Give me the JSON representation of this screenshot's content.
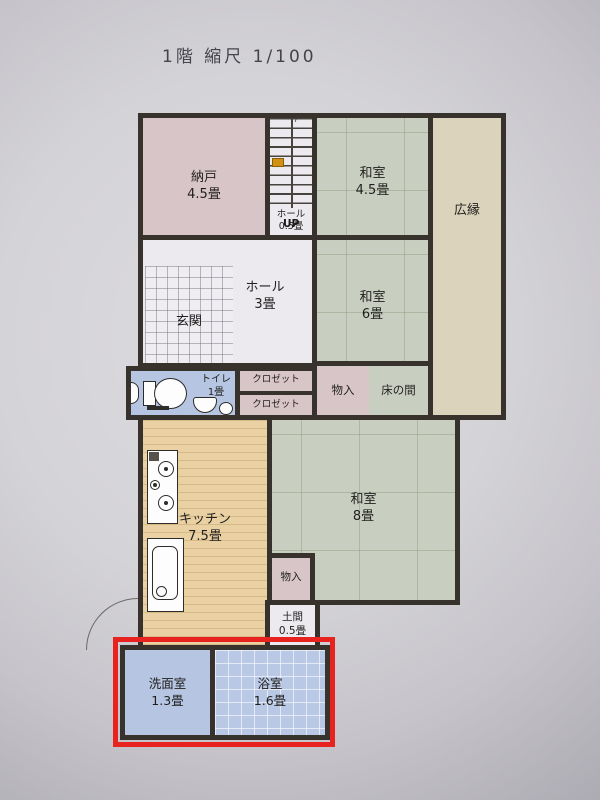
{
  "title": "1階 縮尺 1/100",
  "floor_plan": {
    "rooms": {
      "nando": {
        "name": "納戸",
        "size": "4.5畳"
      },
      "stairs_hall": {
        "name": "ホール",
        "size": "0.5畳",
        "up": "UP"
      },
      "washitsu_45": {
        "name": "和室",
        "size": "4.5畳"
      },
      "hiroen": {
        "name": "広縁"
      },
      "genkan": {
        "name": "玄関"
      },
      "hall_3": {
        "name": "ホール",
        "size": "3畳"
      },
      "washitsu_6": {
        "name": "和室",
        "size": "6畳"
      },
      "toilet": {
        "name": "トイレ",
        "size": "1畳"
      },
      "closet_top": {
        "name": "クロゼット"
      },
      "closet_bottom": {
        "name": "クロゼット"
      },
      "monoire_upper": {
        "name": "物入"
      },
      "tokonoma": {
        "name": "床の間"
      },
      "kitchen": {
        "name": "キッチン",
        "size": "7.5畳"
      },
      "washitsu_8": {
        "name": "和室",
        "size": "8畳"
      },
      "monoire_lower": {
        "name": "物入"
      },
      "doma": {
        "name": "土間",
        "size": "0.5畳"
      },
      "senmenshitsu": {
        "name": "洗面室",
        "size": "1.3畳"
      },
      "yokushitsu": {
        "name": "浴室",
        "size": "1.6畳"
      }
    },
    "highlight": {
      "color": "#e8231f",
      "rooms": [
        "洗面室",
        "浴室"
      ]
    },
    "icons": {
      "up_arrow": "↑"
    },
    "colors": {
      "wall": "#37322c",
      "tatami_green": "#c9cfc0",
      "storage_pink": "#d8c5c8",
      "veranda_beige": "#dcd3bd",
      "kitchen_tan": "#e9d1a4",
      "wet_area_blue": "#b6c5e2",
      "highlight_red": "#e8231f",
      "paper": "#d4d3d7"
    }
  }
}
